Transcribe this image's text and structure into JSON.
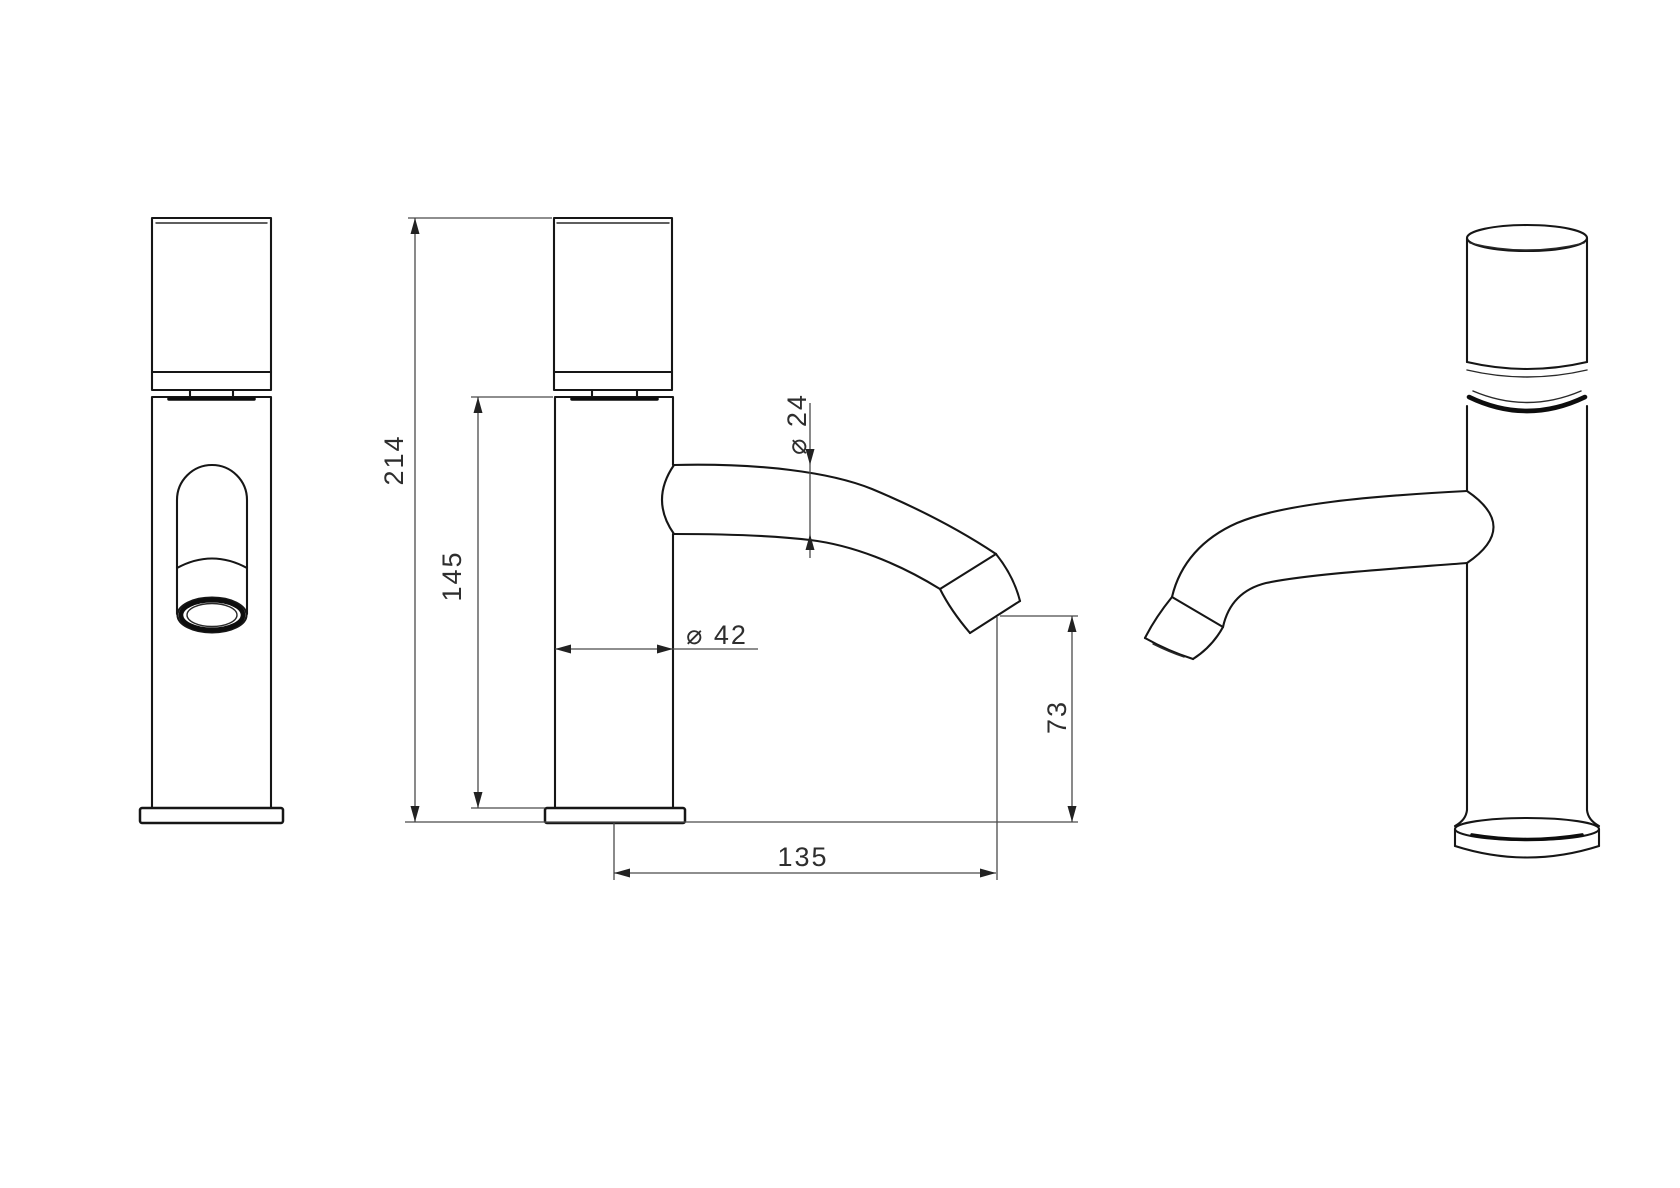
{
  "drawing": {
    "background": "#ffffff",
    "object_line_color": "#161616",
    "dimension_line_color": "#4a4a4a",
    "text_color": "#2e2e2e",
    "dims": {
      "overall_height": "214",
      "body_height": "145",
      "spout_diameter": "⌀ 24",
      "body_diameter": "⌀ 42",
      "outlet_height": "73",
      "spout_reach": "135"
    }
  }
}
